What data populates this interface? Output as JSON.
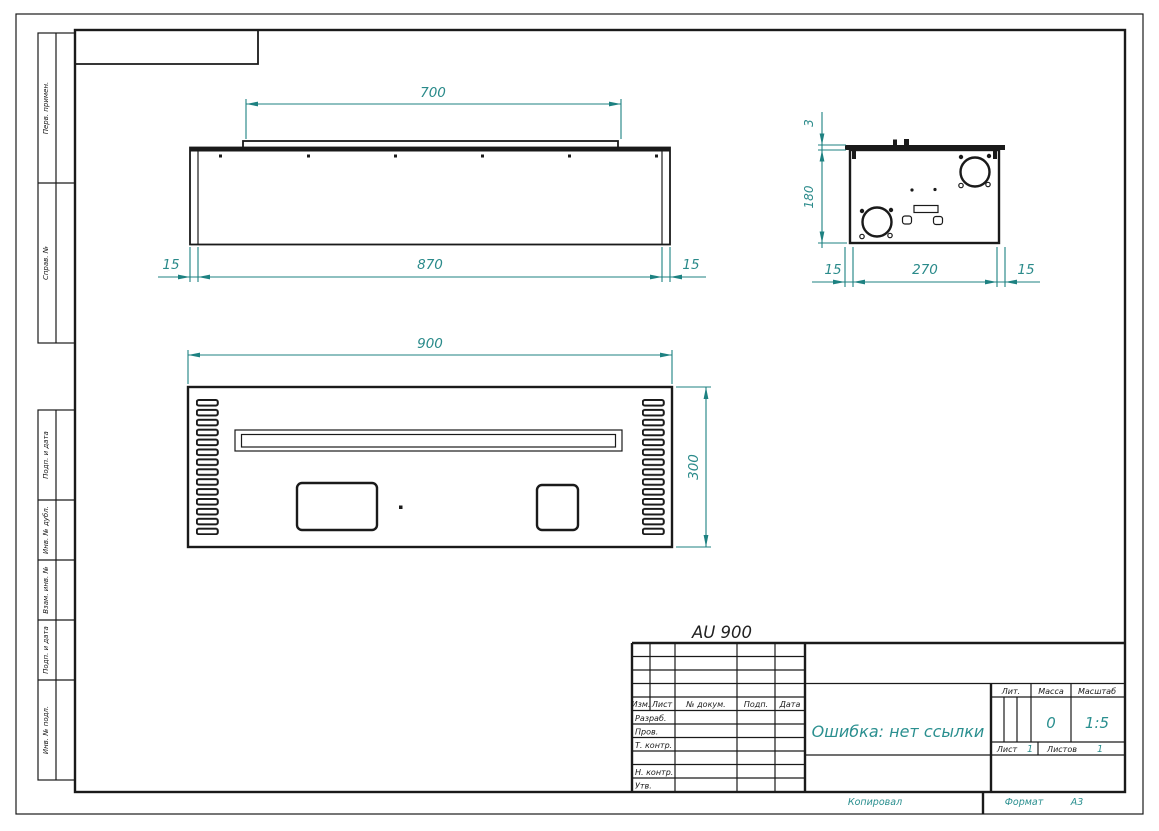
{
  "drawing_title": "AU 900",
  "views": {
    "front": {
      "dim_top": "700",
      "dim_bottom": "870",
      "dim_left": "15",
      "dim_right": "15"
    },
    "side": {
      "dim_flange": "3",
      "dim_height": "180",
      "dim_left": "15",
      "dim_width": "270",
      "dim_right": "15"
    },
    "panel": {
      "dim_width": "900",
      "dim_height": "300"
    }
  },
  "margin_labels": [
    "Перв. примен.",
    "Справ. №",
    "Подп. и дата",
    "Инв. № дубл.",
    "Взам. инв. №",
    "Подп. и дата",
    "Инв. № подл."
  ],
  "title_block": {
    "revision_columns": [
      "Изм.",
      "Лист",
      "№ докум.",
      "Подп.",
      "Дата"
    ],
    "roles": [
      "Разраб.",
      "Пров.",
      "Т. контр.",
      "Н. контр.",
      "Утв."
    ],
    "doc_name": "Ошибка: нет ссылки",
    "lit_label": "Лит.",
    "mass_label": "Масса",
    "mass_value": "0",
    "scale_label": "Масштаб",
    "scale_value": "1:5",
    "sheet_label": "Лист",
    "sheet_value": "1",
    "sheets_label": "Листов",
    "sheets_value": "1"
  },
  "footer": {
    "copied_label": "Копировал",
    "format_label": "Формат",
    "format_value": "А3"
  },
  "colors": {
    "dimension": "#1d8181",
    "line": "#1a1a1a"
  }
}
